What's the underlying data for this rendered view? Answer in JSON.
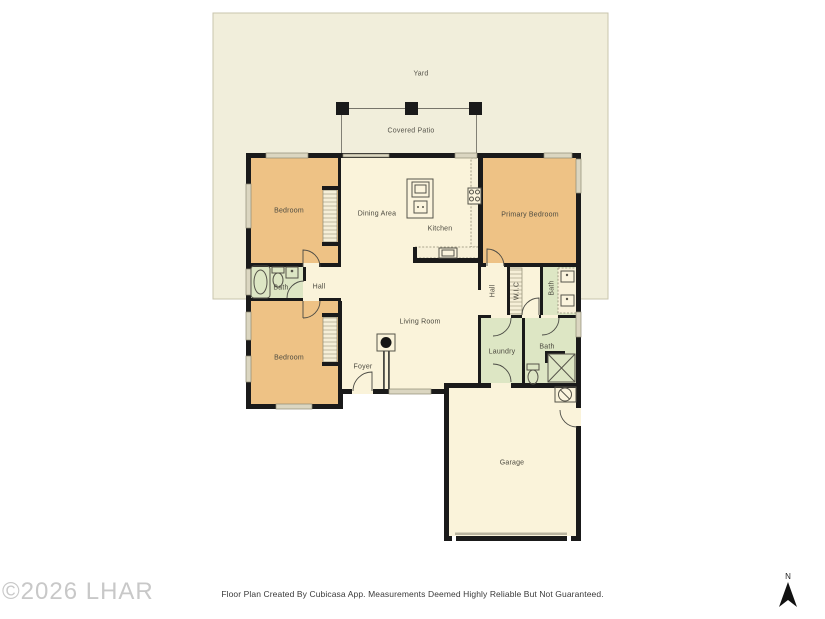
{
  "outdoor": {
    "yard": "Yard",
    "covered_patio": "Covered Patio"
  },
  "rooms": {
    "bedroom_top": "Bedroom",
    "dining_area": "Dining Area",
    "kitchen": "Kitchen",
    "primary_bedroom": "Primary Bedroom",
    "bath_left": "Bath",
    "hall_left": "Hall",
    "living_room": "Living Room",
    "hall_right": "Hall",
    "wic": "W.I.C",
    "bath_top_right": "Bath",
    "bedroom_bottom": "Bedroom",
    "foyer": "Foyer",
    "laundry": "Laundry",
    "bath_bottom_right": "Bath",
    "garage": "Garage"
  },
  "footer": {
    "disclaimer": "Floor Plan Created By Cubicasa App. Measurements Deemed Highly Reliable But Not Guaranteed."
  },
  "watermark": "©2026 LHAR",
  "compass": {
    "north_label": "N"
  },
  "colors": {
    "yard": "#f1eedb",
    "common": "#faf3da",
    "bedroom": "#eec285",
    "wet": "#dde6c4",
    "wall": "#1a1a1a",
    "window_fill": "#dbd6c1",
    "counter": "#f7f0d8",
    "watermark": "#c8c8c8"
  }
}
